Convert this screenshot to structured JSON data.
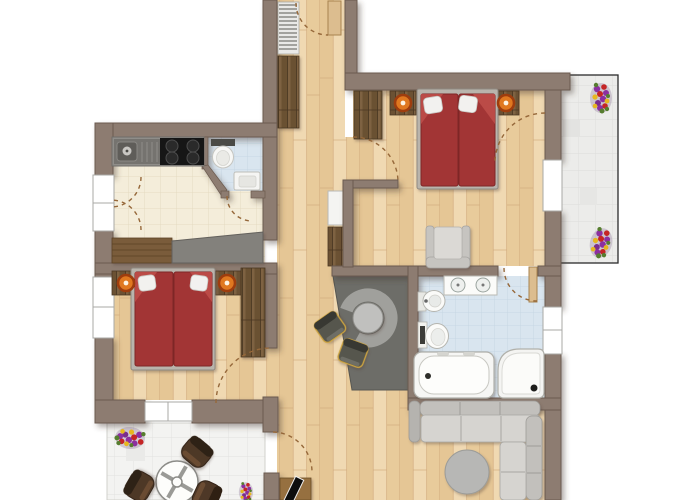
{
  "document": {
    "title": "Apartment floor plan (top-down view)",
    "type": "architectural-floor-plan",
    "visible_text": []
  },
  "palette": {
    "background": "#ffffff",
    "wall": "#8d7c71",
    "wall_edge": "#6b5a4f",
    "wood_floor": "#ecd2a8",
    "kitchen_floor": "#f4edda",
    "bath_tile": "#d9e5ef",
    "terrace_tile": "#f3f3f1",
    "balcony_tile": "#ececea",
    "bed_cover": "#a23434",
    "pillow": "#f2f1ef",
    "lamp_accent": "#e07820",
    "dark_wood": "#6b5133",
    "sofa": "#d6d4d0",
    "gray_zone": "#6d6d68",
    "door_swing": "#96683a",
    "door_leaf": "#dcbd8f",
    "flower_purple": "#8c2fa0",
    "flower_red": "#c52525",
    "flower_yellow": "#e7b71e",
    "leaf_green": "#567d2e"
  },
  "rooms": [
    {
      "id": "entry-hall",
      "label": "Entry hall",
      "floor": "wood",
      "furniture": [
        "entry-door",
        "coat-rack",
        "wardrobe"
      ]
    },
    {
      "id": "hallway",
      "label": "Hallway",
      "floor": "wood",
      "furniture": [
        "console-shelf",
        "wardrobe",
        "round-table-with-curved-bench",
        "two-chairs"
      ]
    },
    {
      "id": "kitchen",
      "label": "Kitchen",
      "floor": "cream-tile",
      "furniture": [
        "sink-counter",
        "cooktop-4-burners",
        "sideboard-with-gray-counter",
        "double-french-door"
      ]
    },
    {
      "id": "wc",
      "label": "Guest WC",
      "floor": "blue-tile",
      "furniture": [
        "toilet",
        "hand-basin"
      ]
    },
    {
      "id": "bedroom-right",
      "label": "Bedroom top right",
      "floor": "wood",
      "furniture": [
        "double-bed-red",
        "two-nightstands-with-lamps",
        "wardrobe",
        "armchair",
        "balcony-door"
      ]
    },
    {
      "id": "bedroom-left",
      "label": "Bedroom left",
      "floor": "wood",
      "furniture": [
        "double-bed-red",
        "two-nightstands-with-lamps",
        "wardrobe",
        "window"
      ]
    },
    {
      "id": "bathroom",
      "label": "Bathroom",
      "floor": "blue-tile",
      "furniture": [
        "double-vanity",
        "bidet",
        "toilet",
        "bathtub",
        "corner-shower"
      ]
    },
    {
      "id": "living-room",
      "label": "Living room",
      "floor": "wood",
      "furniture": [
        "corner-sofa",
        "coffee-table",
        "tv-sideboard",
        "flower-pot-small"
      ]
    },
    {
      "id": "terrace",
      "label": "Terrace bottom left",
      "floor": "light-tile",
      "furniture": [
        "round-table",
        "three-chairs",
        "flower-pot"
      ]
    },
    {
      "id": "balcony",
      "label": "Balcony right",
      "floor": "light-tile",
      "furniture": [
        "flower-pot-top",
        "flower-pot-bottom"
      ]
    }
  ],
  "counts": {
    "bedrooms": 2,
    "beds": 2,
    "flower_pots": 4,
    "door_swings": 9,
    "windows": 5
  }
}
